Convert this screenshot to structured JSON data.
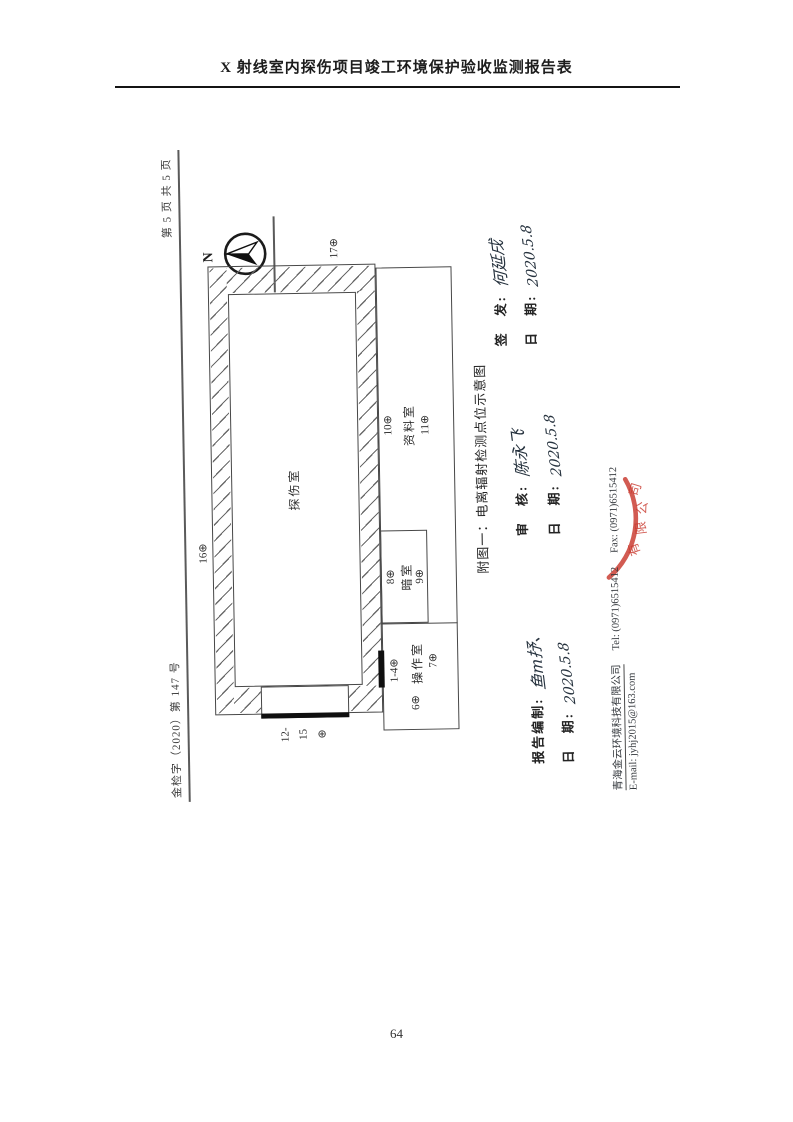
{
  "page": {
    "title": "X 射线室内探伤项目竣工环境保护验收监测报告表",
    "page_number": "64"
  },
  "scan": {
    "doc_number": "金检字（2020）第 147 号",
    "page_info": "第 5 页 共 5 页",
    "compass": "N",
    "plan": {
      "room_main": "探伤室",
      "room_dark": "暗室",
      "room_op": "操作室",
      "room_archive": "资料室",
      "p1_4": "1-4⊕",
      "p6": "6⊕",
      "p7": "7⊕",
      "p8": "8⊕",
      "p9": "9⊕",
      "p10": "10⊕",
      "p11": "11⊕",
      "p16": "16⊕",
      "p17": "17⊕",
      "p12_15": [
        "12-",
        "15",
        "⊕"
      ]
    },
    "caption": "附图一：电离辐射检测点位示意图",
    "sign": {
      "prepared_label": "报告编制:",
      "prepared_sig": "鱼m抒、",
      "prepared_date_label": "日　期:",
      "prepared_date": "2020.5.8",
      "review_label": "审　核:",
      "review_sig": "陈永飞",
      "review_date_label": "日　期:",
      "review_date": "2020.5.8",
      "issue_label": "签　发:",
      "issue_sig": "何延戌",
      "issue_date_label": "日　期:",
      "issue_date": "2020.5.8"
    },
    "footer": {
      "company": "青海金云环境科技有限公司",
      "tel": "Tel:  (0971)6515412",
      "fax": "Fax:  (0971)6515412",
      "email": "E-mail:  jyhj2015@163.com"
    },
    "stamp": [
      "有",
      "限",
      "公",
      "司"
    ]
  },
  "colors": {
    "stamp_red": "#c8372c",
    "ink": "#26323e",
    "line_gray": "#474747"
  }
}
